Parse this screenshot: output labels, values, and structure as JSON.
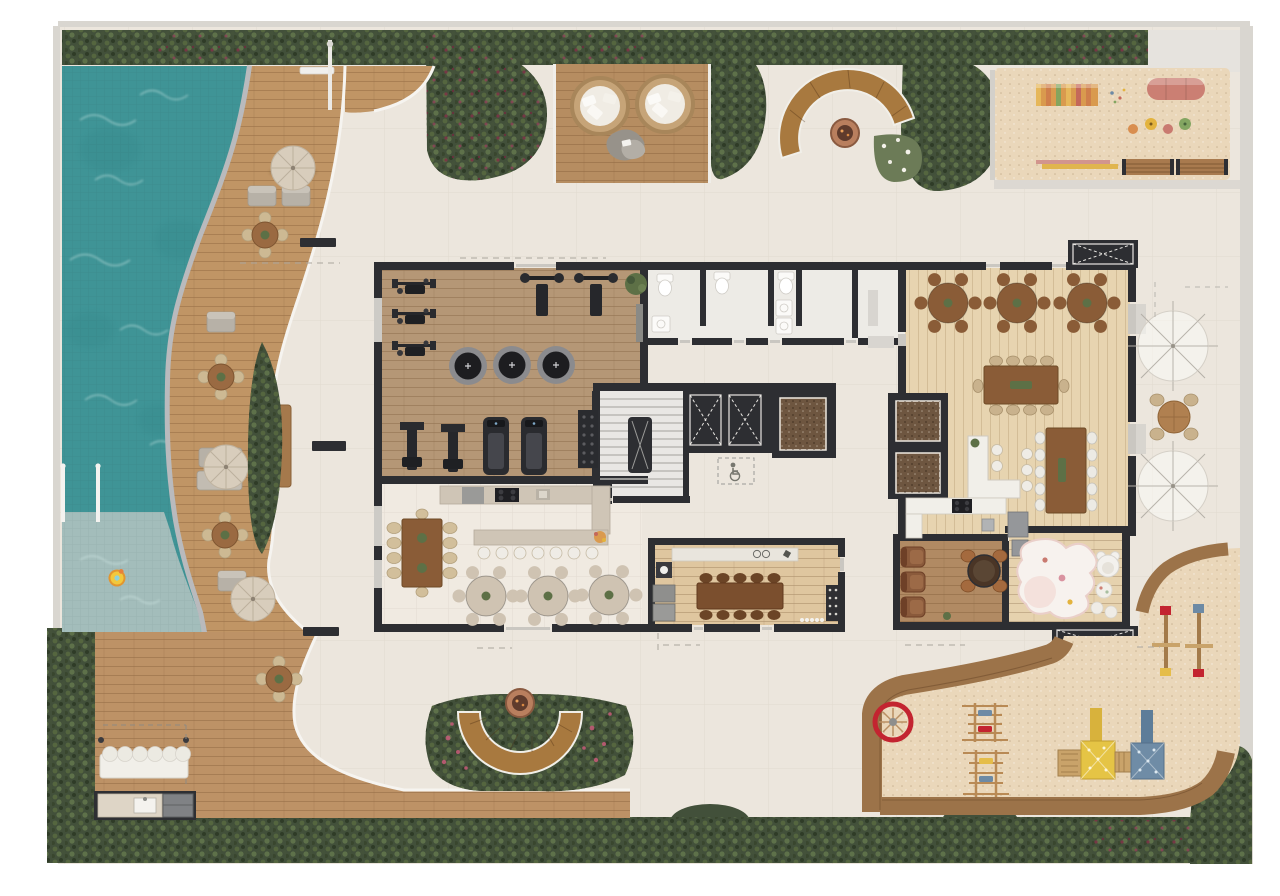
{
  "title": "residential-amenities-ground-floor-plan",
  "colors": {
    "page": "#ffffff",
    "paving": "#ece6dd",
    "boundary": "#d9d6d0",
    "wall": "#2d2e32",
    "opening": "#cac7c1",
    "poolDeep": "#3f9496",
    "poolShallow": "#a3bdbb",
    "coping": "#b9babd",
    "deckWood": "#c09565",
    "topDeckWood": "#b68d61",
    "bottomDeckWood": "#bd9266",
    "walkBand": "#9c7349",
    "hedge": "#42503a",
    "hedgeDark": "#2f3b28",
    "flower": "#7e3347",
    "sand": "#ead7ba",
    "gymFloor": "#b59776",
    "gourmetFloor": "#f0eae1",
    "partyFloor": "#e7d4b0",
    "wineFloor": "#dfc69f",
    "gamesFloor": "#b18a63",
    "kidsFloor": "#e6d2ae",
    "bathFloor": "#edebe6",
    "stairFloor": "#e9e7e4",
    "elevatorCab": "#6e5640",
    "furnitureWood": "#8a5c37",
    "chairBeige": "#d2bf9b",
    "travertine": "#cfc3b2",
    "counterWhite": "#f1efe9",
    "equipmentBlack": "#2a2b2f",
    "applianceGray": "#95979a",
    "leather": "#8a5a3b",
    "umbrellaBeige": "#d8cdbc",
    "copper": "#b97f5e",
    "accentRed": "#c32430",
    "accentYellow": "#e5bd4a",
    "accentBlue": "#6d8aa5",
    "accentPink": "#cf8176",
    "accentGreen": "#7ea45f",
    "accentOrange": "#da9a4f"
  },
  "areas": [
    {
      "id": "pool",
      "label": "swimming-pool-with-sun-shelf"
    },
    {
      "id": "pool-deck",
      "label": "curved-pool-deck"
    },
    {
      "id": "lounge-deck",
      "label": "lounge-deck-with-nest-chairs"
    },
    {
      "id": "fire-pit-north",
      "label": "fire-pit-with-curved-bench"
    },
    {
      "id": "playground-north",
      "label": "toddler-sand-playground"
    },
    {
      "id": "gym",
      "label": "fitness-room"
    },
    {
      "id": "restrooms",
      "label": "restrooms-changing-rooms"
    },
    {
      "id": "stair-core",
      "label": "staircase"
    },
    {
      "id": "elevators",
      "label": "elevator-core"
    },
    {
      "id": "gourmet-hall",
      "label": "gourmet-hall-with-bar"
    },
    {
      "id": "wine-room",
      "label": "wine-tasting-room"
    },
    {
      "id": "party-hall",
      "label": "party-hall-with-kitchen"
    },
    {
      "id": "games-lounge",
      "label": "games-lounge"
    },
    {
      "id": "kids-playroom",
      "label": "kids-playroom"
    },
    {
      "id": "terrace-east",
      "label": "outdoor-terrace-with-umbrellas"
    },
    {
      "id": "fire-pit-south",
      "label": "fire-pit-crescent-bench-garden"
    },
    {
      "id": "barbecue-deck",
      "label": "barbecue-deck-with-bench"
    },
    {
      "id": "playground-south",
      "label": "sand-playground-with-playhouses"
    },
    {
      "id": "hedge-border",
      "label": "perimeter-hedge"
    }
  ],
  "inventory": {
    "pool_umbrellas": 4,
    "deck_round_tables": 4,
    "lounge_nest_chairs": 2,
    "fire_pits": 2,
    "gym_trampolines": 3,
    "treadmills": 2,
    "strength_stations": 5,
    "bench_press_stations": 2,
    "party_round_tables": 3,
    "gourmet_round_tables": 3,
    "long_dining_tables": 4,
    "bar_stools": 7,
    "counter_stools": 4,
    "terrace_umbrellas": 2,
    "passenger_elevators": 3,
    "service_elevators": 2,
    "lounge_armchairs": 3,
    "playground_benches": 2,
    "roof_vents": 2
  }
}
